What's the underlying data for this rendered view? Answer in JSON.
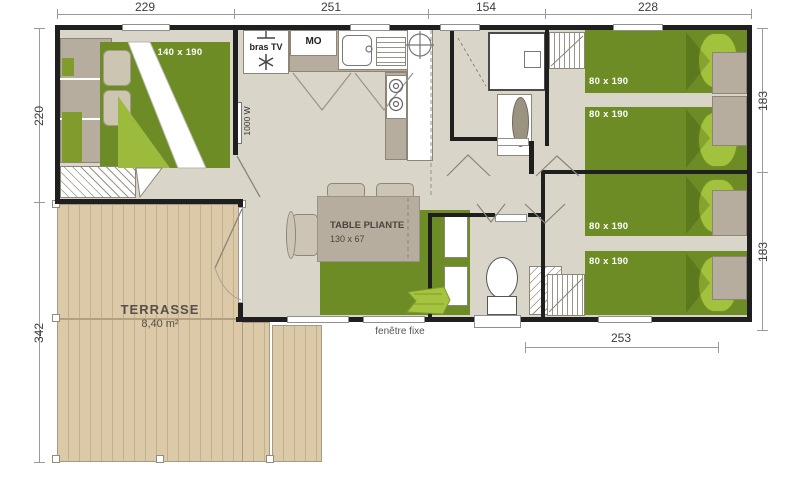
{
  "dimensions": {
    "top": [
      "229",
      "251",
      "154",
      "228"
    ],
    "left": [
      "220",
      "342"
    ],
    "right": [
      "183",
      "183"
    ],
    "bottom": [
      "253"
    ]
  },
  "labels": {
    "master_bed_size": "140 x 190",
    "twin_bed_size_1": "80 x 190",
    "twin_bed_size_2": "80 x 190",
    "twin_bed_size_3": "80 x 190",
    "twin_bed_size_4": "80 x 190",
    "table_name": "TABLE PLIANTE",
    "table_size": "130 x 67",
    "terrace_name": "TERRASSE",
    "terrace_area": "8,40 m²",
    "fixed_window": "fenêtre fixe",
    "tv_bracket": "bras TV",
    "microwave": "MO",
    "heater_power": "1000 W"
  },
  "colors": {
    "wall": "#1f1f1f",
    "floor": "#d9d5c8",
    "deck": "#dcc9a8",
    "bed_green": "#6d8c26",
    "pillow_green": "#a2c23d",
    "furniture_grey": "#b6ad9f"
  }
}
